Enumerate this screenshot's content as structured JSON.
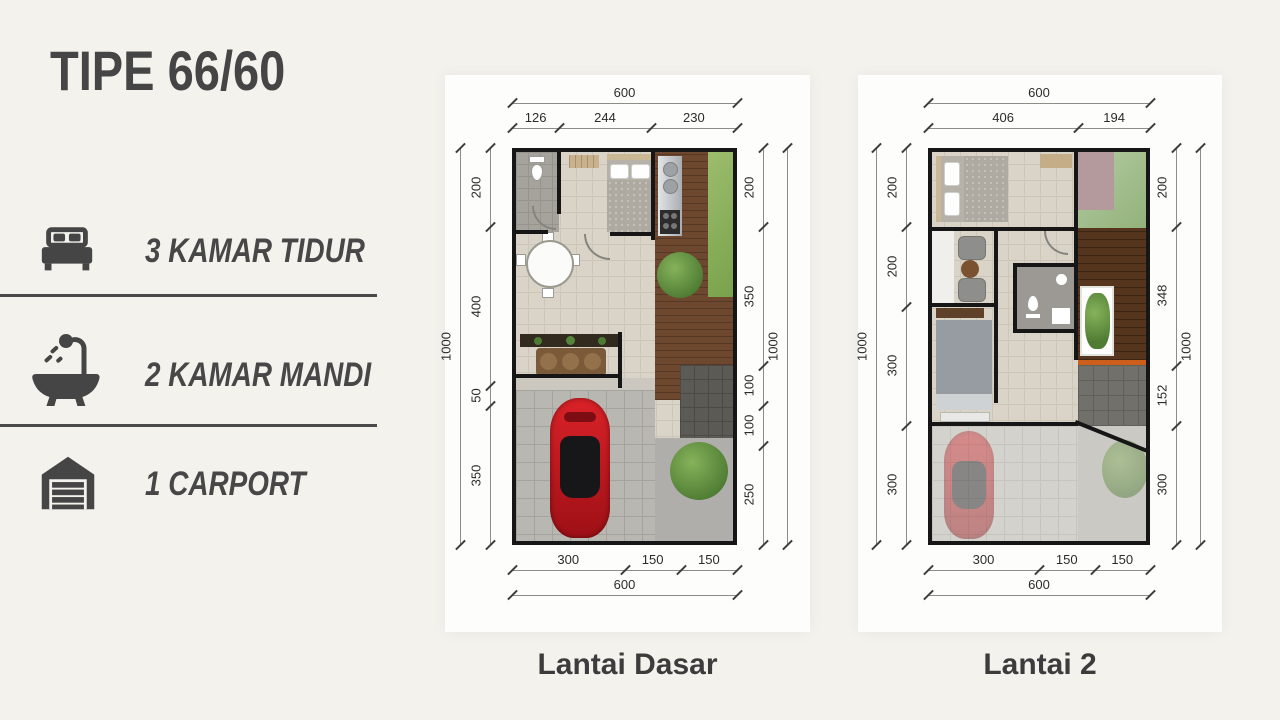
{
  "title": "TIPE 66/60",
  "features": [
    {
      "icon": "bed-icon",
      "label": "3 KAMAR TIDUR"
    },
    {
      "icon": "bathtub-icon",
      "label": "2 KAMAR MANDI"
    },
    {
      "icon": "garage-icon",
      "label": "1 CARPORT"
    }
  ],
  "plans": [
    {
      "label": "Lantai Dasar",
      "dims": {
        "top_total": "600",
        "top_segments": [
          "126",
          "244",
          "230"
        ],
        "left_total": "1000",
        "left_segments": [
          "200",
          "400",
          "50",
          "350"
        ],
        "right_total": "1000",
        "right_segments": [
          "200",
          "350",
          "100",
          "100",
          "250"
        ],
        "bottom_segments": [
          "300",
          "150",
          "150"
        ],
        "bottom_total": "600"
      }
    },
    {
      "label": "Lantai 2",
      "dims": {
        "top_total": "600",
        "top_segments": [
          "406",
          "194"
        ],
        "left_total": "1000",
        "left_segments": [
          "200",
          "200",
          "300",
          "300"
        ],
        "right_total": "1000",
        "right_segments": [
          "200",
          "348",
          "152",
          "300"
        ],
        "bottom_segments": [
          "300",
          "150",
          "150"
        ],
        "bottom_total": "600"
      }
    }
  ],
  "colors": {
    "background": "#f4f2ed",
    "card": "#fdfdfb",
    "ink": "#474747",
    "dimension_text": "#2b2b2b",
    "wall": "#161616",
    "tile_floor": "#dad4c8",
    "wood_floor": "#6d482f",
    "grass": "#8fb55e",
    "car_red": "#c2181f"
  }
}
